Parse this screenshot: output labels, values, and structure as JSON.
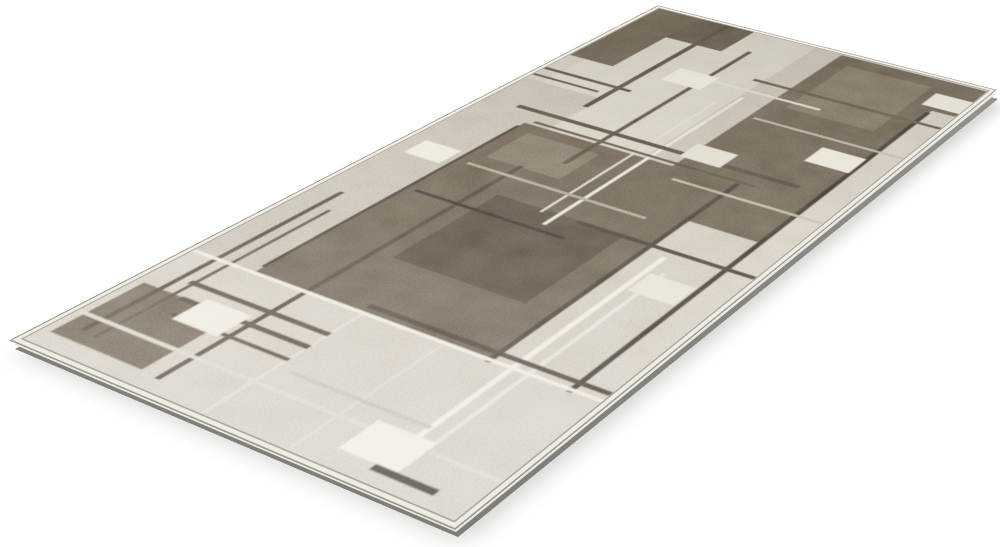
{
  "scene": {
    "description": "Product photo of a modern abstract runner rug in beige, taupe and dark brown, displayed at an angle on a plain white background",
    "background_color": "#ffffff"
  },
  "rug": {
    "plane": {
      "width": 320,
      "height": 600
    },
    "colors": {
      "background": "#ffffff",
      "base": "#c1b8a6",
      "binding": "#efece1",
      "outline": "#97978f",
      "side_light": "#e9e8e2",
      "side_dark": "#96958f",
      "shadow": "#b9b8b3"
    },
    "pattern": [
      {
        "x": 16,
        "y": 0,
        "w": 200,
        "h": 230,
        "c": "#ccc4b2"
      },
      {
        "x": 0,
        "y": 170,
        "w": 72,
        "h": 330,
        "c": "#b2a896"
      },
      {
        "x": 156,
        "y": 0,
        "w": 64,
        "h": 300,
        "c": "#b6ac9a"
      },
      {
        "x": 0,
        "y": 0,
        "w": 96,
        "h": 48,
        "c": "#4e463a"
      },
      {
        "x": 0,
        "y": 0,
        "w": 42,
        "h": 118,
        "c": "#554c3f"
      },
      {
        "x": 181,
        "y": 2,
        "w": 131,
        "h": 292,
        "c": "#584f42"
      },
      {
        "x": 196,
        "y": 18,
        "w": 76,
        "h": 92,
        "c": "#6d6354",
        "o": 0.75
      },
      {
        "x": 206,
        "y": 290,
        "w": 106,
        "h": 215,
        "c": "#c0b7a4"
      },
      {
        "x": 292,
        "y": 56,
        "w": 20,
        "h": 450,
        "c": "#c6bdab"
      },
      {
        "x": 51,
        "y": 232,
        "w": 184,
        "h": 246,
        "c": "#574e41"
      },
      {
        "x": 108,
        "y": 326,
        "w": 104,
        "h": 96,
        "c": "#463e32"
      },
      {
        "x": 64,
        "y": 244,
        "w": 64,
        "h": 44,
        "c": "#6e6456",
        "o": 0.8
      },
      {
        "x": 0,
        "y": 476,
        "w": 312,
        "h": 116,
        "c": "#c5bcaa"
      },
      {
        "x": 6,
        "y": 518,
        "w": 74,
        "h": 62,
        "c": "#5a5144"
      },
      {
        "x": 68,
        "y": 0,
        "w": 5,
        "h": 188,
        "c": "#453e33"
      },
      {
        "x": 114,
        "y": 36,
        "w": 4,
        "h": 232,
        "c": "#474034"
      },
      {
        "x": 158,
        "y": 112,
        "w": 3,
        "h": 230,
        "c": "#e2ddca"
      },
      {
        "x": 146,
        "y": 130,
        "w": 2,
        "h": 200,
        "c": "#d8d2bf"
      },
      {
        "x": 232,
        "y": 230,
        "w": 4,
        "h": 250,
        "c": "#39332b"
      },
      {
        "x": 49,
        "y": 238,
        "w": 3,
        "h": 232,
        "c": "#3c352c"
      },
      {
        "x": 92,
        "y": 286,
        "w": 4,
        "h": 296,
        "c": "#413a30"
      },
      {
        "x": 18,
        "y": 376,
        "w": 4,
        "h": 194,
        "c": "#433c32"
      },
      {
        "x": 30,
        "y": 398,
        "w": 3,
        "h": 174,
        "c": "#4a4337"
      },
      {
        "x": 248,
        "y": 336,
        "w": 4,
        "h": 236,
        "c": "#e9e4d2"
      },
      {
        "x": 260,
        "y": 352,
        "w": 3,
        "h": 220,
        "c": "#ded7c4"
      },
      {
        "x": 289,
        "y": 60,
        "w": 4,
        "h": 420,
        "c": "#322d27"
      },
      {
        "x": 138,
        "y": 476,
        "w": 3,
        "h": 116,
        "c": "#d3ccb9"
      },
      {
        "x": 200,
        "y": 476,
        "w": 2,
        "h": 116,
        "c": "#d0c9b6"
      },
      {
        "x": 28,
        "y": 210,
        "w": 244,
        "h": 5,
        "c": "#453e33"
      },
      {
        "x": 56,
        "y": 226,
        "w": 190,
        "h": 3,
        "c": "#4a4336"
      },
      {
        "x": 0,
        "y": 146,
        "w": 82,
        "h": 4,
        "c": "#463f34"
      },
      {
        "x": 0,
        "y": 160,
        "w": 62,
        "h": 3,
        "c": "#463f34"
      },
      {
        "x": 148,
        "y": 78,
        "w": 164,
        "h": 4,
        "c": "#4f473b"
      },
      {
        "x": 96,
        "y": 98,
        "w": 124,
        "h": 3,
        "c": "#d9d2c0"
      },
      {
        "x": 186,
        "y": 136,
        "w": 126,
        "h": 3,
        "c": "#aaa08e",
        "o": 0.9
      },
      {
        "x": 192,
        "y": 246,
        "w": 120,
        "h": 3,
        "c": "#a89e8c",
        "o": 0.9
      },
      {
        "x": 176,
        "y": 326,
        "w": 136,
        "h": 4,
        "c": "#3a342b"
      },
      {
        "x": 58,
        "y": 348,
        "w": 124,
        "h": 3,
        "c": "#2f2a24"
      },
      {
        "x": 60,
        "y": 300,
        "w": 150,
        "h": 3,
        "c": "#93897a"
      },
      {
        "x": 136,
        "y": 468,
        "w": 176,
        "h": 4,
        "c": "#3d362d"
      },
      {
        "x": 0,
        "y": 476,
        "w": 312,
        "h": 3,
        "c": "#e8e3d1"
      },
      {
        "x": 28,
        "y": 502,
        "w": 112,
        "h": 4,
        "c": "#453e33"
      },
      {
        "x": 38,
        "y": 517,
        "w": 102,
        "h": 4,
        "c": "#453e33"
      },
      {
        "x": 48,
        "y": 532,
        "w": 92,
        "h": 3,
        "c": "#453e33"
      },
      {
        "x": 0,
        "y": 556,
        "w": 312,
        "h": 3,
        "c": "#cfc8b6"
      },
      {
        "x": 150,
        "y": 540,
        "w": 100,
        "h": 3,
        "c": "#b3a997"
      },
      {
        "x": 248,
        "y": 578,
        "w": 42,
        "h": 5,
        "c": "#332e28"
      },
      {
        "x": 88,
        "y": 92,
        "w": 36,
        "h": 26,
        "c": "#e9e4d3"
      },
      {
        "x": 254,
        "y": 152,
        "w": 36,
        "h": 25,
        "c": "#e6e1cf"
      },
      {
        "x": 280,
        "y": 26,
        "w": 34,
        "h": 24,
        "c": "#eae5d4"
      },
      {
        "x": 12,
        "y": 290,
        "w": 32,
        "h": 22,
        "c": "#e4dfcd"
      },
      {
        "x": 52,
        "y": 512,
        "w": 36,
        "h": 25,
        "c": "#e7e2d0"
      },
      {
        "x": 222,
        "y": 550,
        "w": 40,
        "h": 28,
        "c": "#eae5d4"
      },
      {
        "x": 254,
        "y": 356,
        "w": 34,
        "h": 23,
        "c": "#ddd6c3"
      },
      {
        "x": 176,
        "y": 194,
        "w": 34,
        "h": 23,
        "c": "#d9d2bf"
      }
    ]
  }
}
